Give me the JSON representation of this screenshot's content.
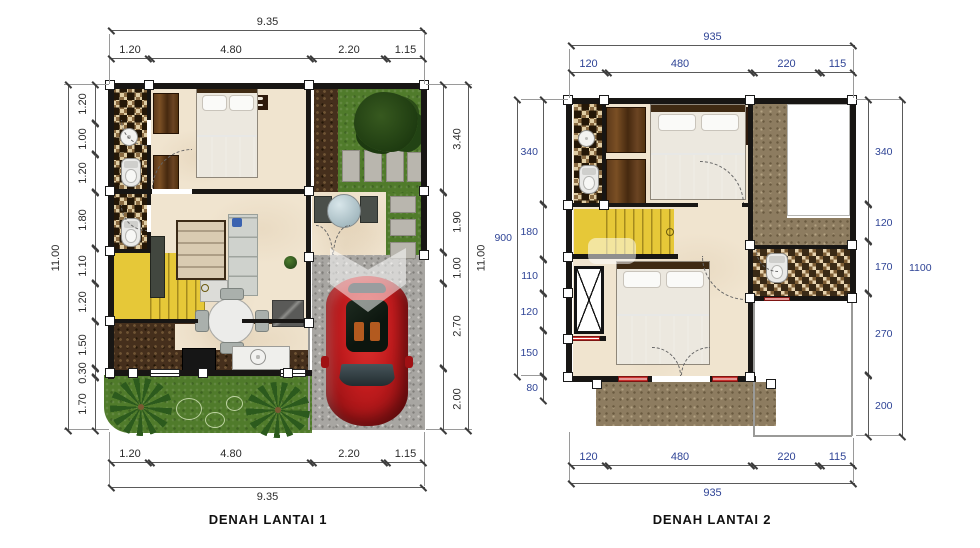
{
  "figures": [
    {
      "title": "DENAH LANTAI 1",
      "dims": {
        "top_total": "9.35",
        "top_segments": [
          "1.20",
          "4.80",
          "2.20",
          "1.15"
        ],
        "bottom_segments": [
          "1.20",
          "4.80",
          "2.20",
          "1.15"
        ],
        "bottom_total": "9.35",
        "left_total": "11.00",
        "left_segments": [
          "1.20",
          "1.00",
          "1.20",
          "1.80",
          "1.10",
          "1.20",
          "1.50",
          "0.30",
          "1.70"
        ],
        "right_segments": [
          "3.40",
          "1.90",
          "1.00",
          "2.70",
          "2.00"
        ],
        "right_total": "11.00"
      }
    },
    {
      "title": "DENAH LANTAI 2",
      "dims": {
        "top_total": "935",
        "top_segments": [
          "120",
          "480",
          "220",
          "115"
        ],
        "bottom_segments": [
          "120",
          "480",
          "220",
          "115"
        ],
        "bottom_total": "935",
        "left_total": "900",
        "left_below_total": "80",
        "left_segments": [
          "340",
          "180",
          "110",
          "120",
          "150"
        ],
        "right_segments": [
          "340",
          "120",
          "170",
          "270",
          "200"
        ],
        "right_total": "1100"
      }
    }
  ],
  "colors": {
    "wall": "#181614",
    "floor": "#f0e4cf",
    "stairs_yellow": "#e6c838",
    "grass_green": "#507b2b",
    "gravel_gray": "#a8a6a2",
    "soil_brown": "#452f1c",
    "car_red": "#c01b1d",
    "dim_text_floor1": "#2b2b2b",
    "dim_text_floor2": "#2f4496"
  }
}
